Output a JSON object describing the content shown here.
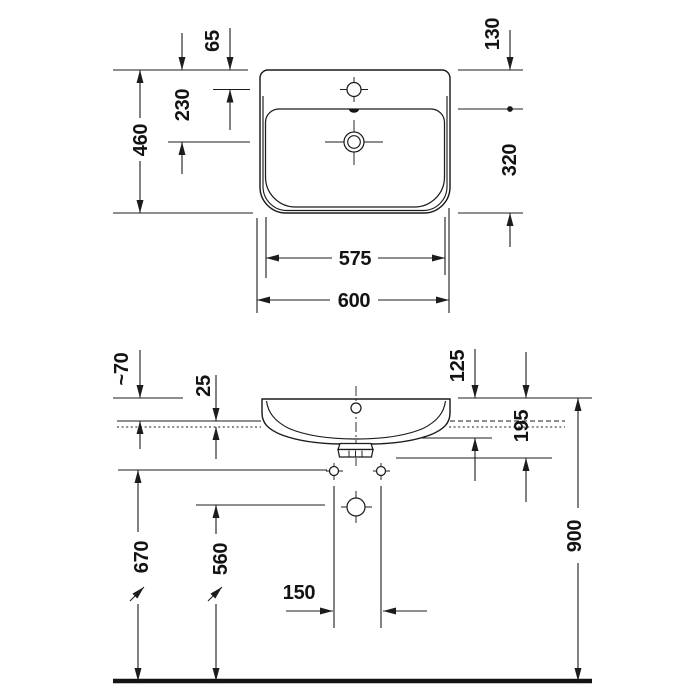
{
  "dimensions": {
    "plan": {
      "rear_to_tap_hole": "65",
      "rear_to_drain": "230",
      "overall_depth": "460",
      "rear_zone": "130",
      "bowl_zone": "320",
      "bowl_width": "575",
      "overall_width": "600"
    },
    "elevation": {
      "rim_above_mount": "~70",
      "mount_offset": "25",
      "body_height": "125",
      "rim_to_outlet": "195",
      "rim_height": "900",
      "fixing_hole_height": "670",
      "drain_height": "560",
      "fixing_hole_spacing": "150"
    }
  }
}
